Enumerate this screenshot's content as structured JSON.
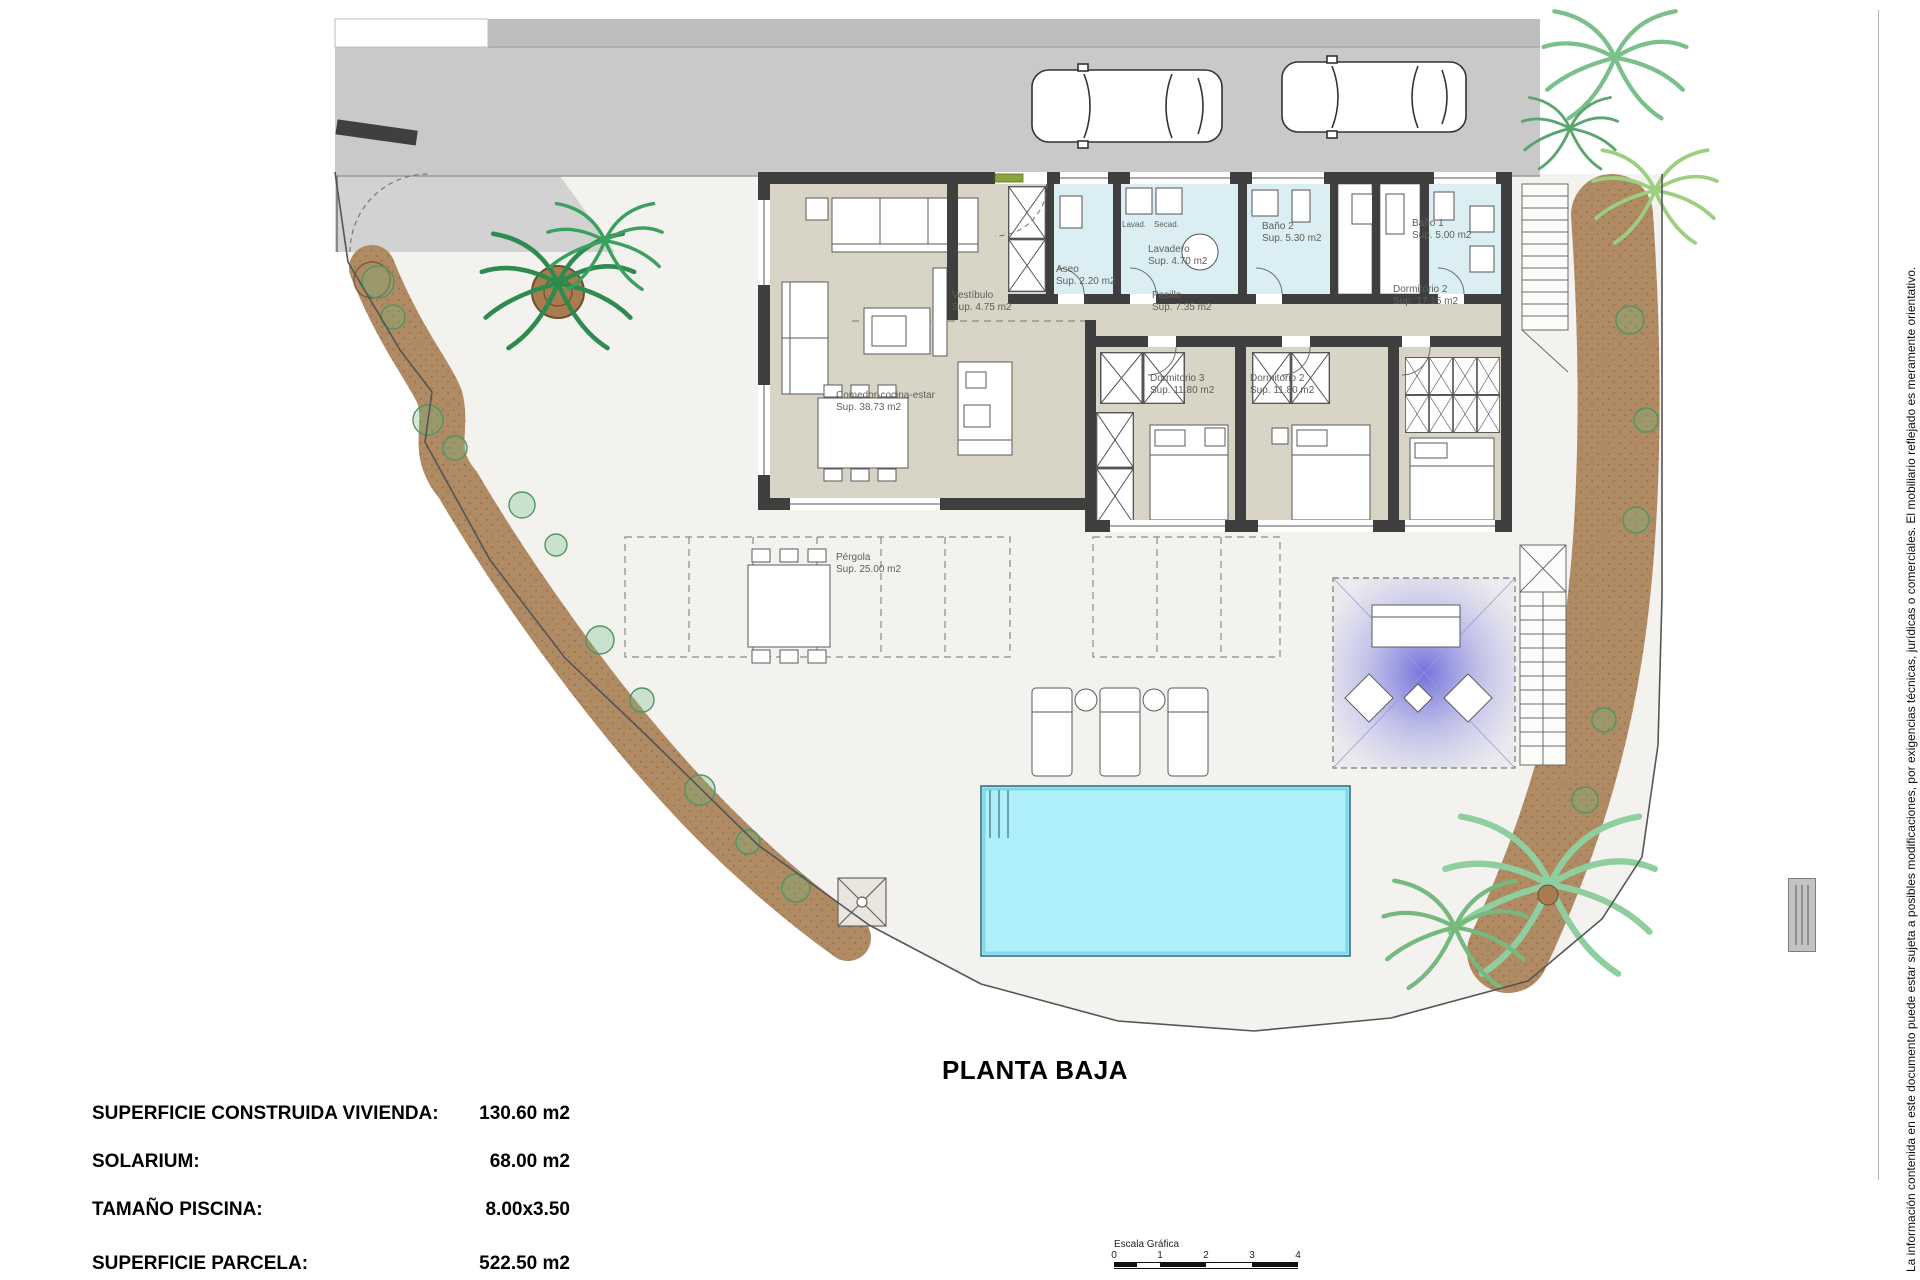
{
  "title": "PLANTA BAJA",
  "info": {
    "rows": [
      {
        "label": "SUPERFICIE CONSTRUIDA VIVIENDA:",
        "value": "130.60 m2"
      },
      {
        "label": "SOLARIUM:",
        "value": "68.00 m2"
      },
      {
        "label": "TAMAÑO PISCINA:",
        "value": "8.00x3.50"
      },
      {
        "label": "SUPERFICIE PARCELA:",
        "value": "522.50 m2"
      }
    ]
  },
  "rooms": [
    {
      "name": "Comedor-cocina-estar",
      "sup": "Sup. 38.73 m2"
    },
    {
      "name": "Vestíbulo",
      "sup": "Sup. 4.75 m2"
    },
    {
      "name": "Aseo",
      "sup": "Sup. 2.20 m2"
    },
    {
      "name": "Lavadero",
      "sup": "Sup. 4.70 m2"
    },
    {
      "name": "Pasillo",
      "sup": "Sup. 7.35 m2"
    },
    {
      "name": "Baño 2",
      "sup": "Sup. 5.30 m2"
    },
    {
      "name": "Baño 1",
      "sup": "Sup. 5.00 m2"
    },
    {
      "name": "Dormitorio 3",
      "sup": "Sup. 11.80 m2"
    },
    {
      "name": "Dormitorio 2",
      "sup": "Sup. 11.80 m2"
    },
    {
      "name": "Dormitorio 2",
      "sup": "Sup. 17.15 m2"
    },
    {
      "name": "Pérgola",
      "sup": "Sup. 25.00 m2"
    }
  ],
  "appliances": {
    "washer": "Lavad.",
    "dryer": "Secad."
  },
  "scale_bar": {
    "caption": "Escala Gráfica",
    "ticks": [
      "0",
      "1",
      "2",
      "3",
      "4"
    ]
  },
  "disclaimer": "La información contenida en este documento puede estar sujeta a posibles modificaciones, por exigencias técnicas, jurídicas o comerciales. El mobiliario reflejado es meramente orientativo.",
  "colors": {
    "wall": "#3f3f3f",
    "floor_beige": "#d8d4c6",
    "floor_wet": "#daeef3",
    "road": "#c9c9c9",
    "pool": "#aeeffa",
    "gravel": "#b08a62",
    "solarium_glow": "#5050dc",
    "palm_green": "#2e8b4f"
  }
}
